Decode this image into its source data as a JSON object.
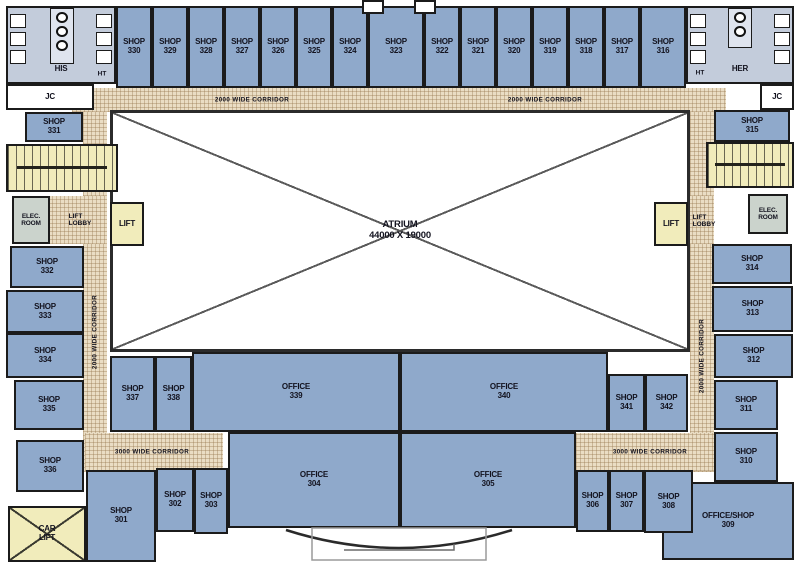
{
  "plan": {
    "atrium": {
      "line1": "ATRIUM",
      "line2": "44000 X 19000"
    },
    "corridors": {
      "top_left": "2000 WIDE CORRIDOR",
      "top_right": "2000 WIDE CORRIDOR",
      "left": "2000 WIDE CORRIDOR",
      "right": "2000 WIDE CORRIDOR",
      "bottom_left": "3000 WIDE CORRIDOR",
      "bottom_right": "3000 WIDE CORRIDOR"
    },
    "rooms": {
      "shop330": {
        "name": "SHOP",
        "num": "330"
      },
      "shop329": {
        "name": "SHOP",
        "num": "329"
      },
      "shop328": {
        "name": "SHOP",
        "num": "328"
      },
      "shop327": {
        "name": "SHOP",
        "num": "327"
      },
      "shop326": {
        "name": "SHOP",
        "num": "326"
      },
      "shop325": {
        "name": "SHOP",
        "num": "325"
      },
      "shop324": {
        "name": "SHOP",
        "num": "324"
      },
      "shop323": {
        "name": "SHOP",
        "num": "323"
      },
      "shop322": {
        "name": "SHOP",
        "num": "322"
      },
      "shop321": {
        "name": "SHOP",
        "num": "321"
      },
      "shop320": {
        "name": "SHOP",
        "num": "320"
      },
      "shop319": {
        "name": "SHOP",
        "num": "319"
      },
      "shop318": {
        "name": "SHOP",
        "num": "318"
      },
      "shop317": {
        "name": "SHOP",
        "num": "317"
      },
      "shop316": {
        "name": "SHOP",
        "num": "316"
      },
      "shop331": {
        "name": "SHOP",
        "num": "331"
      },
      "shop332": {
        "name": "SHOP",
        "num": "332"
      },
      "shop333": {
        "name": "SHOP",
        "num": "333"
      },
      "shop334": {
        "name": "SHOP",
        "num": "334"
      },
      "shop335": {
        "name": "SHOP",
        "num": "335"
      },
      "shop336": {
        "name": "SHOP",
        "num": "336"
      },
      "shop301": {
        "name": "SHOP",
        "num": "301"
      },
      "shop302": {
        "name": "SHOP",
        "num": "302"
      },
      "shop303": {
        "name": "SHOP",
        "num": "303"
      },
      "shop337": {
        "name": "SHOP",
        "num": "337"
      },
      "shop338": {
        "name": "SHOP",
        "num": "338"
      },
      "office339": {
        "name": "OFFICE",
        "num": "339"
      },
      "office340": {
        "name": "OFFICE",
        "num": "340"
      },
      "office304": {
        "name": "OFFICE",
        "num": "304"
      },
      "office305": {
        "name": "OFFICE",
        "num": "305"
      },
      "shop341": {
        "name": "SHOP",
        "num": "341"
      },
      "shop342": {
        "name": "SHOP",
        "num": "342"
      },
      "shop306": {
        "name": "SHOP",
        "num": "306"
      },
      "shop307": {
        "name": "SHOP",
        "num": "307"
      },
      "shop308": {
        "name": "SHOP",
        "num": "308"
      },
      "officeshop309": {
        "name": "OFFICE/SHOP",
        "num": "309"
      },
      "shop310": {
        "name": "SHOP",
        "num": "310"
      },
      "shop311": {
        "name": "SHOP",
        "num": "311"
      },
      "shop312": {
        "name": "SHOP",
        "num": "312"
      },
      "shop313": {
        "name": "SHOP",
        "num": "313"
      },
      "shop314": {
        "name": "SHOP",
        "num": "314"
      },
      "shop315": {
        "name": "SHOP",
        "num": "315"
      },
      "his": {
        "name": "HIS"
      },
      "her": {
        "name": "HER"
      },
      "jc_left": {
        "name": "JC"
      },
      "jc_right": {
        "name": "JC"
      },
      "ht_left": {
        "name": "HT"
      },
      "ht_right": {
        "name": "HT"
      },
      "elec_left": {
        "name": "ELEC.",
        "num": "ROOM"
      },
      "elec_right": {
        "name": "ELEC.",
        "num": "ROOM"
      },
      "lift_left": {
        "name": "LIFT"
      },
      "lift_right": {
        "name": "LIFT"
      },
      "lobby_left": {
        "name": "LIFT",
        "num": "LOBBY"
      },
      "lobby_right": {
        "name": "LIFT",
        "num": "LOBBY"
      },
      "carlift": {
        "name": "CAR",
        "num": "LIFT"
      }
    },
    "colors": {
      "shop_fill": "#8FA9CB",
      "toilet_fill": "#C3CCDB",
      "corridor_fill": "#EADDC4",
      "stair_lift_fill": "#F1ECBB",
      "elec_fill": "#CBD3CC",
      "wall": "#1B1B1B"
    }
  }
}
